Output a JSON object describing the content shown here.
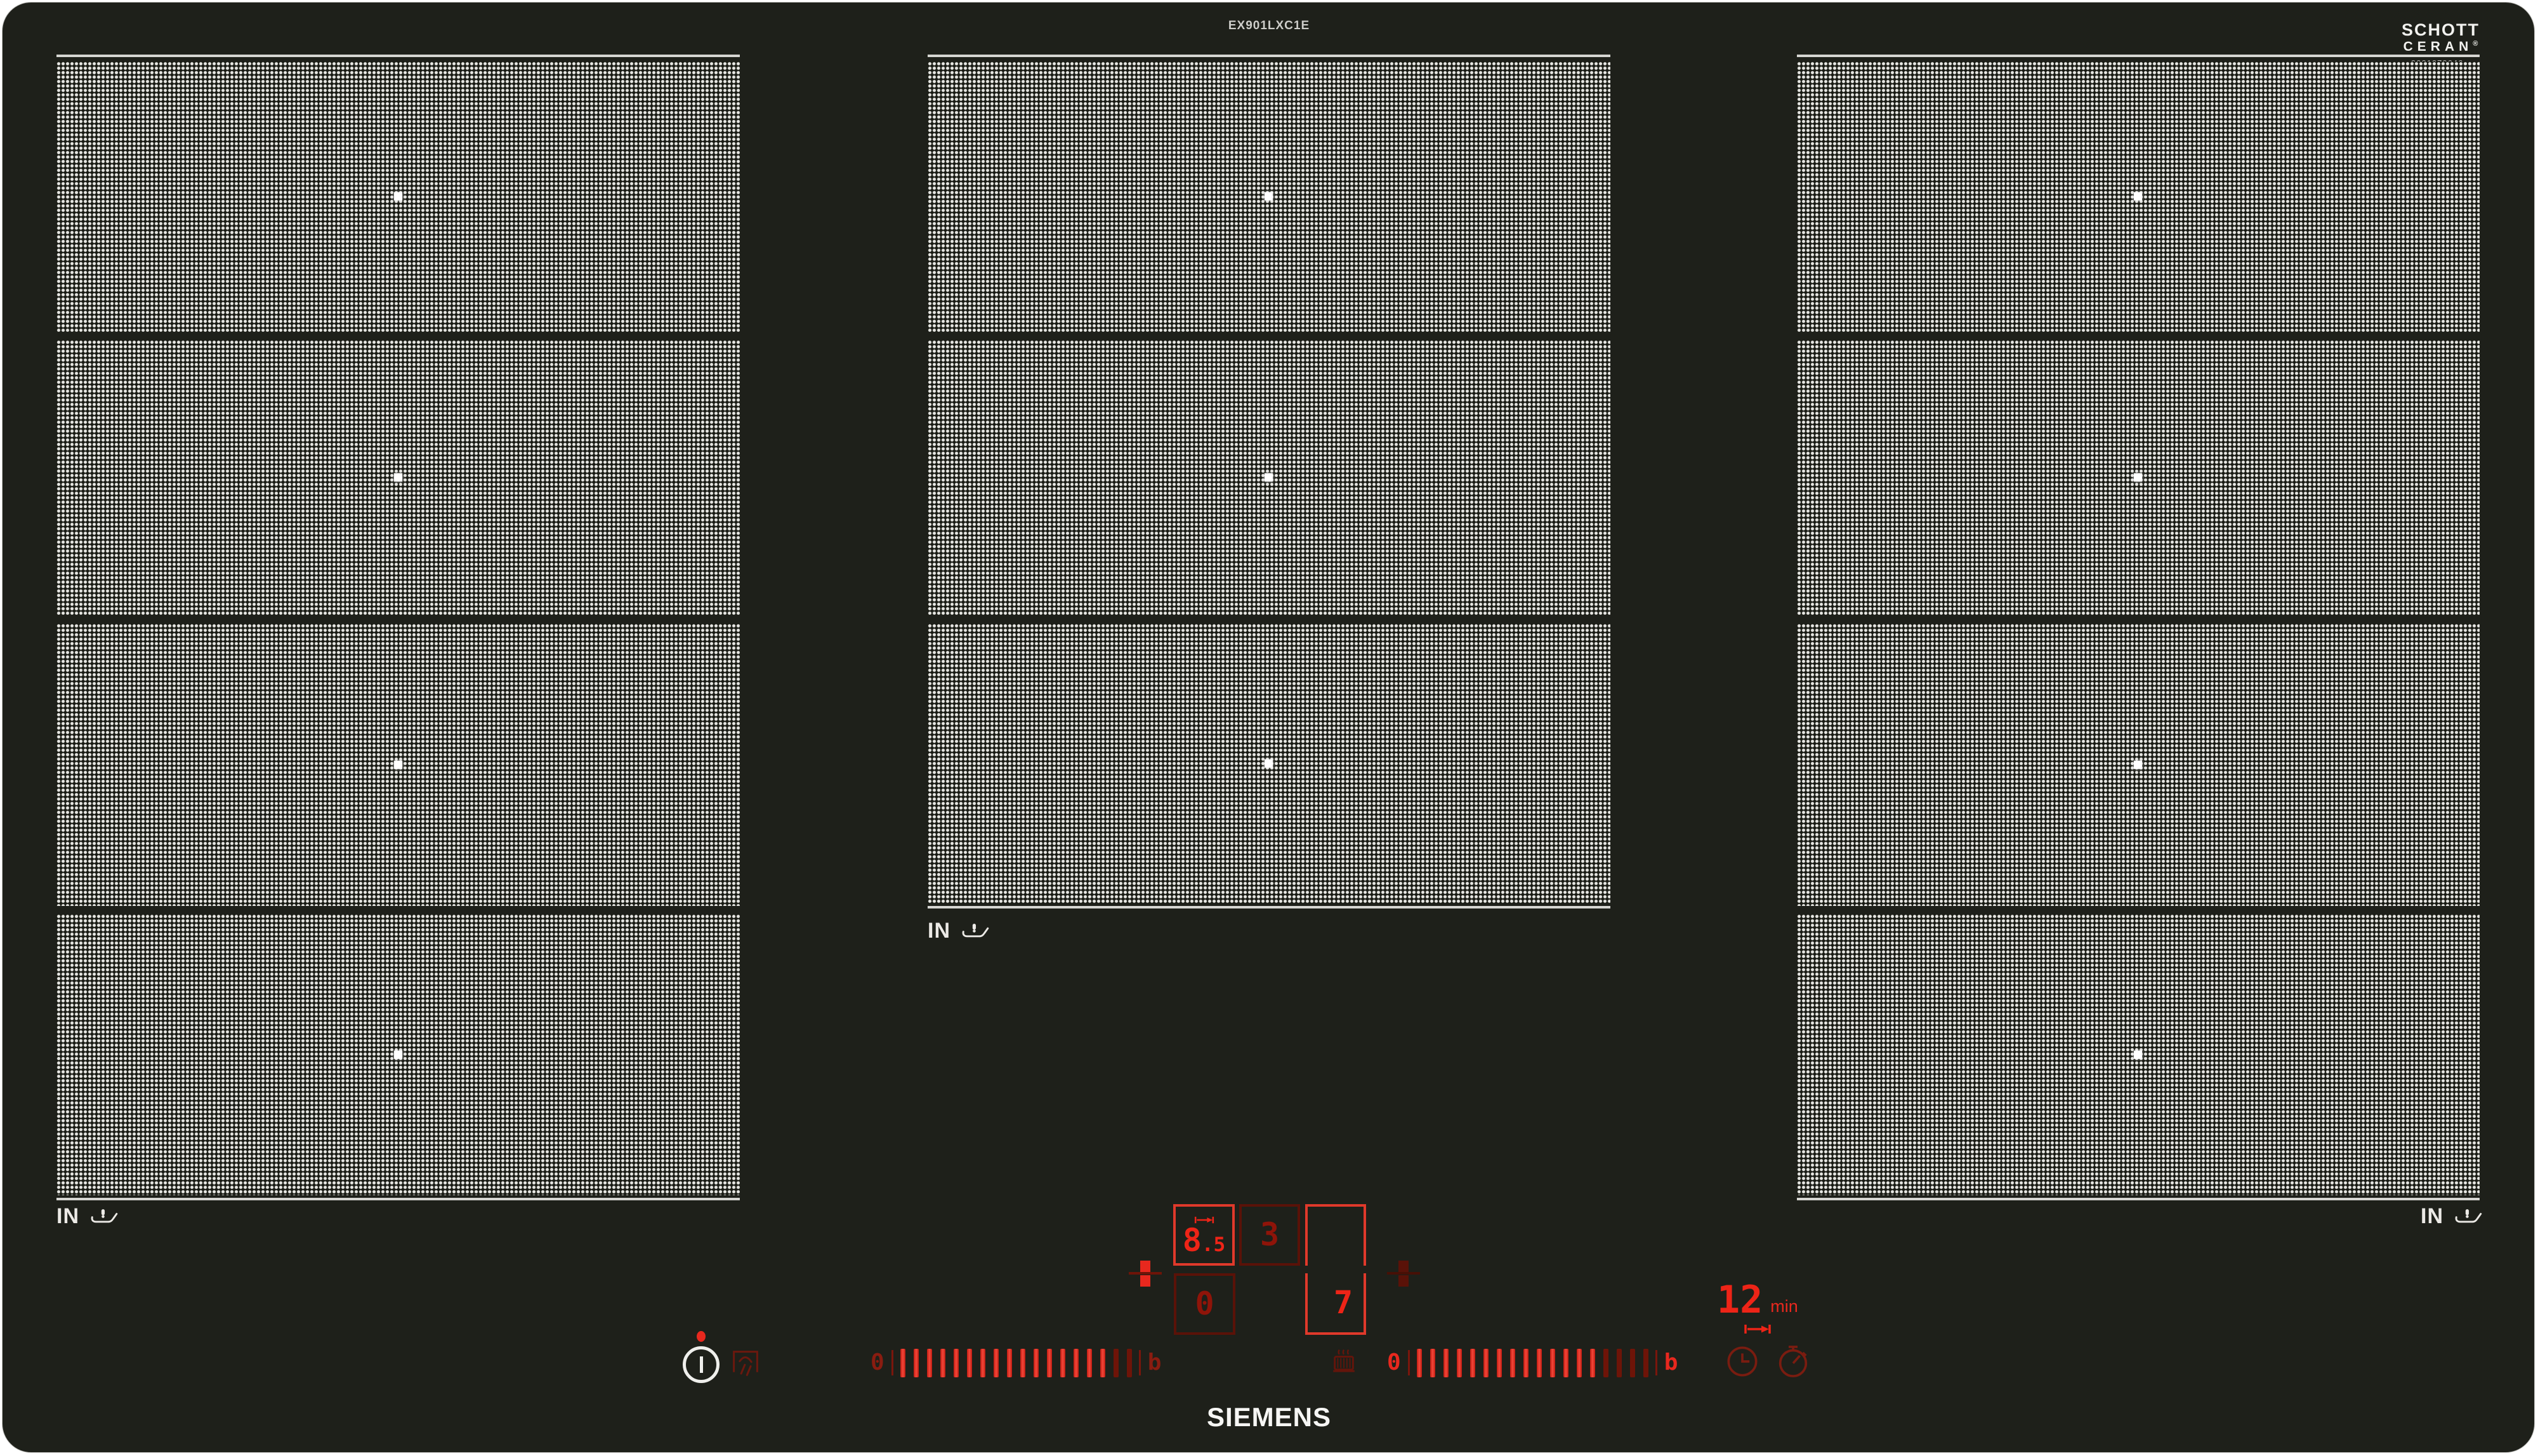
{
  "header": {
    "model": "EX901LXC1E",
    "schott_line1": "SCHOTT",
    "schott_line2": "CERAN",
    "schott_reg": "®",
    "serial": "9001070646"
  },
  "footer": {
    "brand": "SIEMENS"
  },
  "zones": {
    "induction_label": "IN",
    "left_count": 4,
    "center_count": 3,
    "right_count": 4,
    "marker_color": "#ffffff"
  },
  "controls": {
    "flex_display": {
      "main": "8",
      "frac": ".5",
      "secondary": "0"
    },
    "center_display": {
      "value": "3"
    },
    "right_display": {
      "value": "7"
    },
    "timer": {
      "value": "12",
      "unit": "min"
    },
    "sliders": {
      "left": {
        "start_label": "0",
        "end_label": "b",
        "bars_bright": 16,
        "bars_dim": 2
      },
      "right": {
        "start_label": "0",
        "end_label": "b",
        "bars_bright": 14,
        "bars_dim": 4
      }
    },
    "colors": {
      "bright_red": "#ee2417",
      "dim_red": "#6e1408",
      "surface": "#1e201a"
    }
  }
}
